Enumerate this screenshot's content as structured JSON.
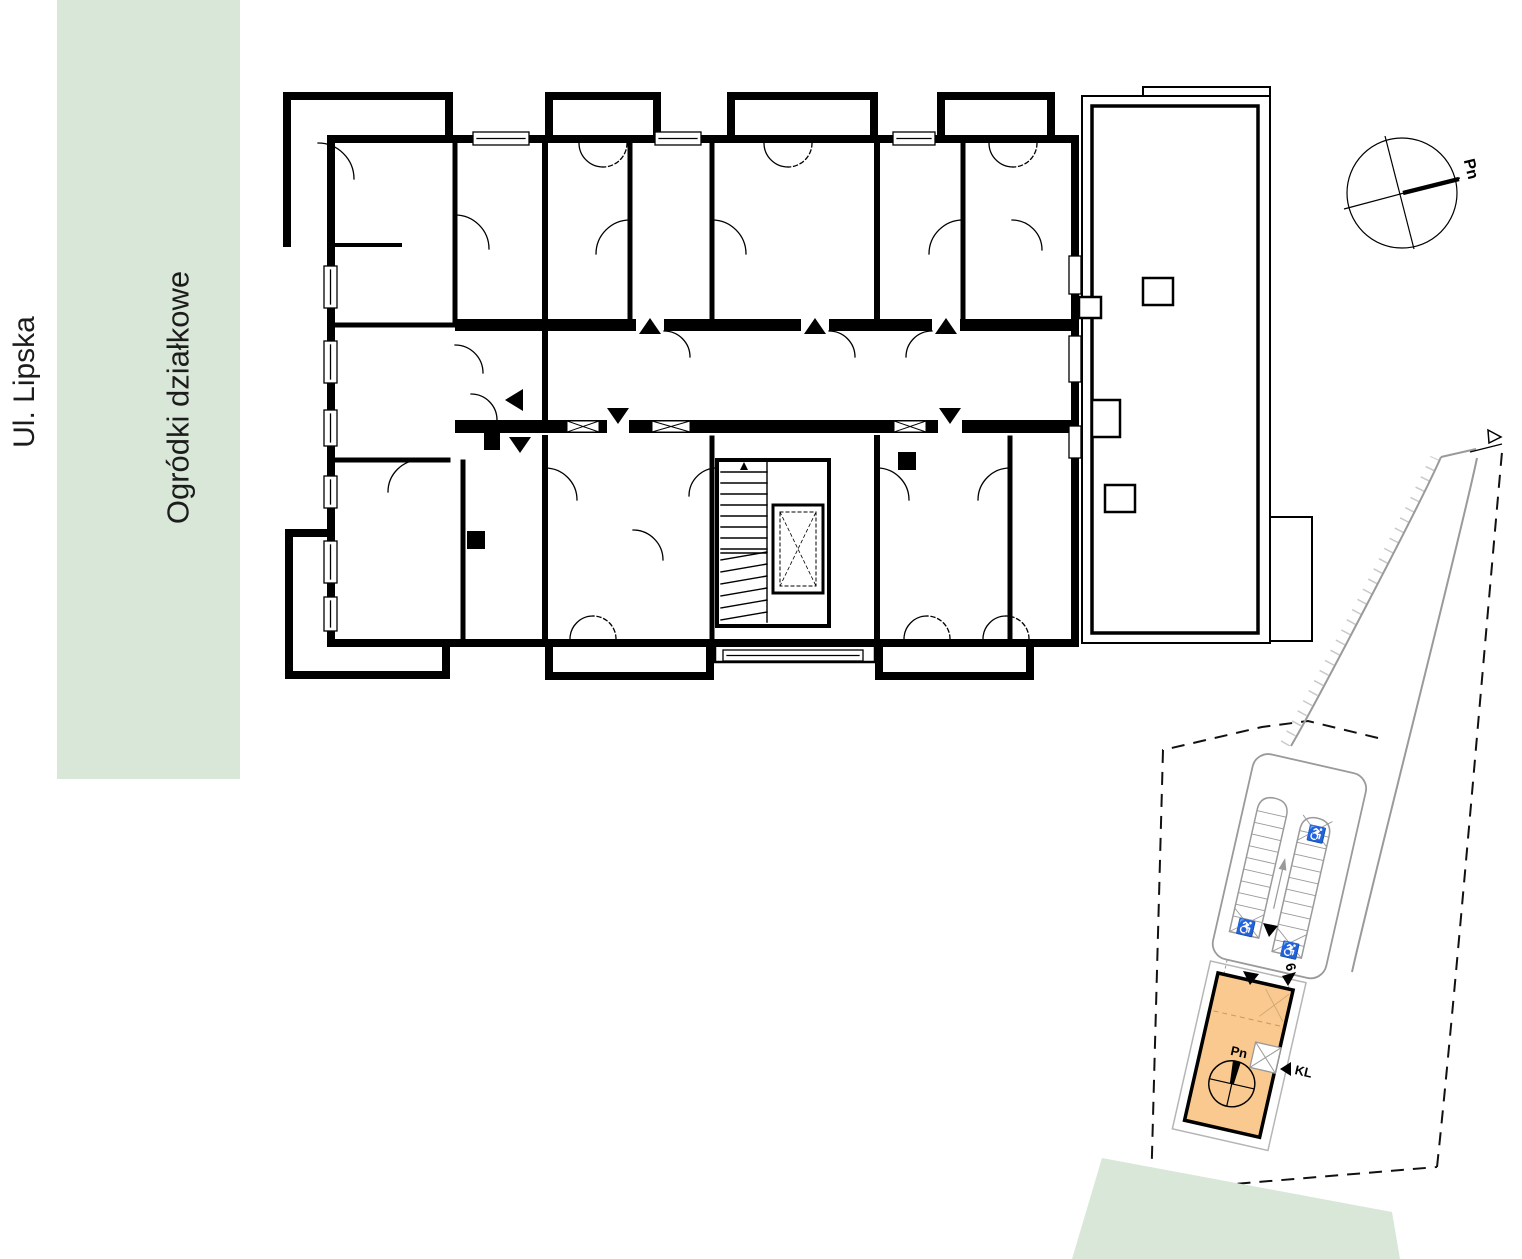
{
  "labels": {
    "street": "Ul. Lipska",
    "allotments": "Ogródki działkowe"
  },
  "compass": {
    "north": "Pn"
  },
  "site_plan": {
    "north": "Pn",
    "staircase": "KL",
    "entrance_number": "6",
    "wheelchair_icon": "♿"
  },
  "colors": {
    "garden_green": "#d9e7d9",
    "building_orange": "#f9c98f",
    "plan_black": "#000000",
    "site_gray": "#9a9a9a"
  }
}
